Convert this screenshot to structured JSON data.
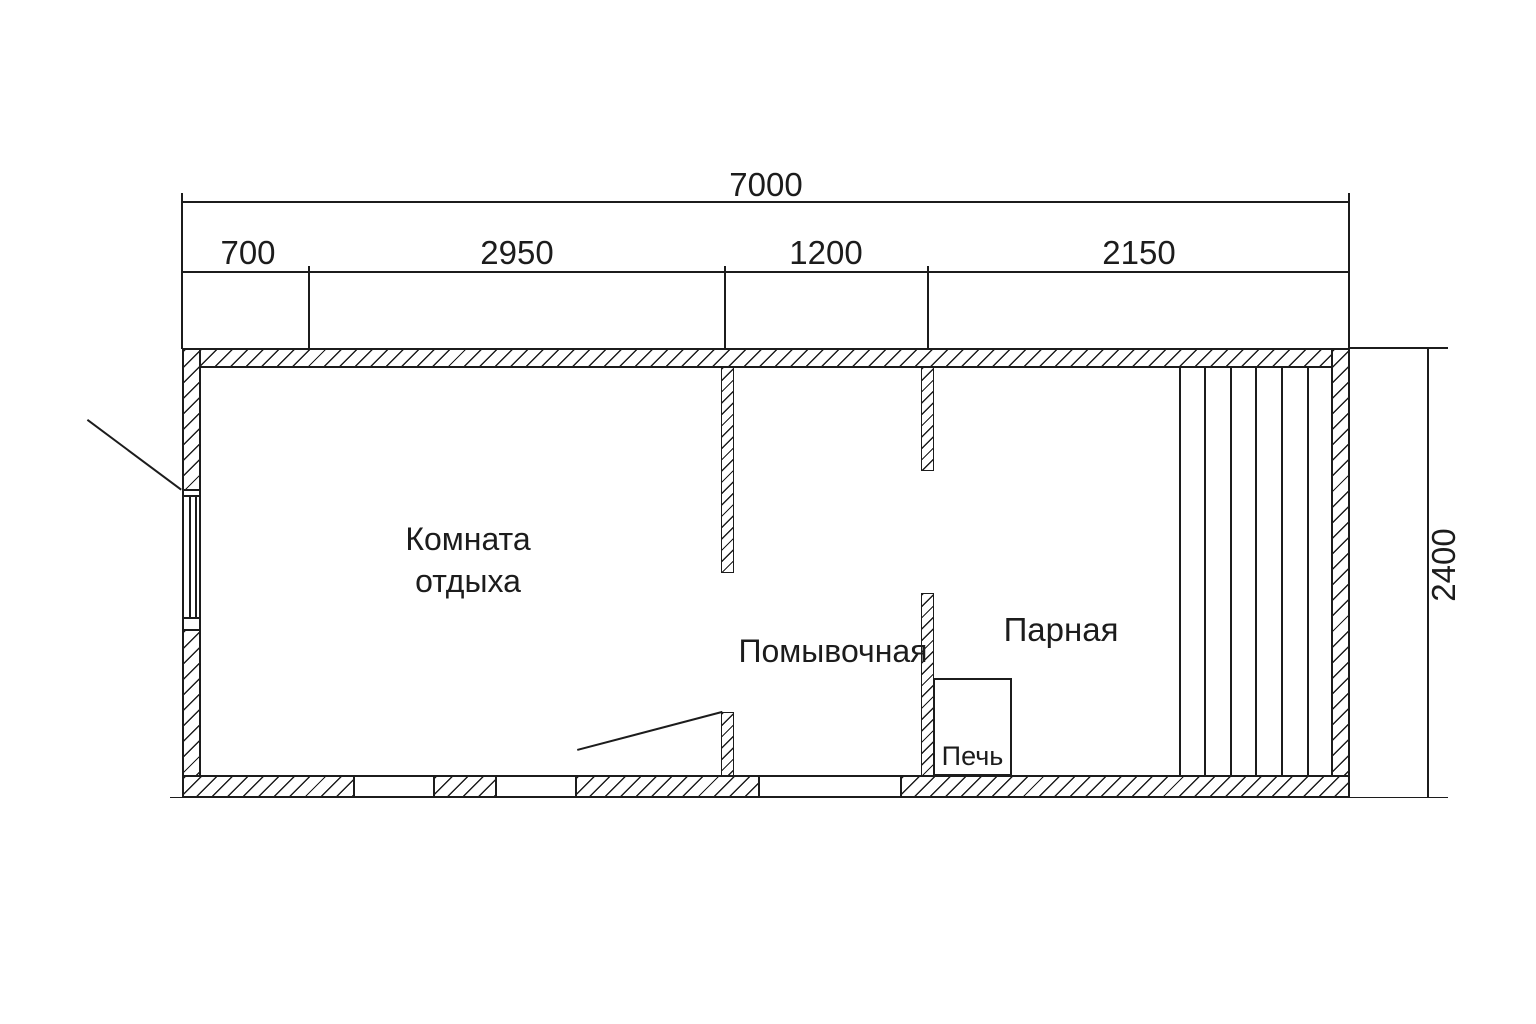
{
  "drawing": {
    "type": "floor-plan",
    "background": "#ffffff",
    "line_color": "#1c1c1c"
  },
  "dimensions": {
    "total_width": "7000",
    "segments": [
      "700",
      "2950",
      "1200",
      "2150"
    ],
    "height": "2400"
  },
  "rooms": {
    "rest_room": {
      "label_line1": "Комната",
      "label_line2": "отдыха"
    },
    "wash_room": {
      "label": "Помывочная"
    },
    "steam_room": {
      "label": "Парная"
    },
    "stove": {
      "label": "Печь"
    }
  }
}
